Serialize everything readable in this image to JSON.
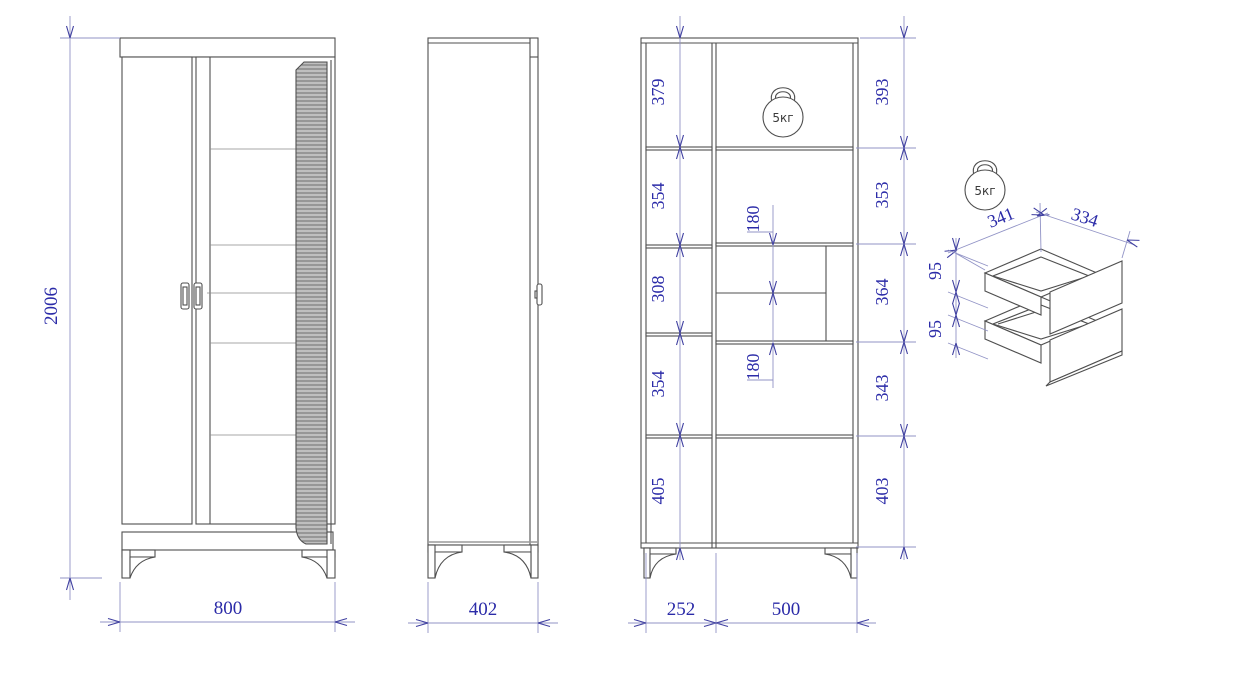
{
  "labels": {
    "kettlebell": "5кг"
  },
  "front_view": {
    "height": "2006",
    "width": "800"
  },
  "side_view": {
    "depth": "402"
  },
  "internal_view": {
    "left_sections": [
      "379",
      "354",
      "308",
      "354",
      "405"
    ],
    "right_sections": [
      "393",
      "353",
      "364",
      "343",
      "403"
    ],
    "drawer_heights": [
      "180",
      "180"
    ],
    "bottom_widths": [
      "252",
      "500"
    ]
  },
  "drawer_detail": {
    "depth": "341",
    "width": "334",
    "heights": [
      "95",
      "95"
    ]
  },
  "colors": {
    "dimension_text": "#2b2ba8",
    "dimension_line": "#9193c6",
    "drawing_line": "#4f4f4f",
    "rib_fill": "#c9c9c9"
  }
}
